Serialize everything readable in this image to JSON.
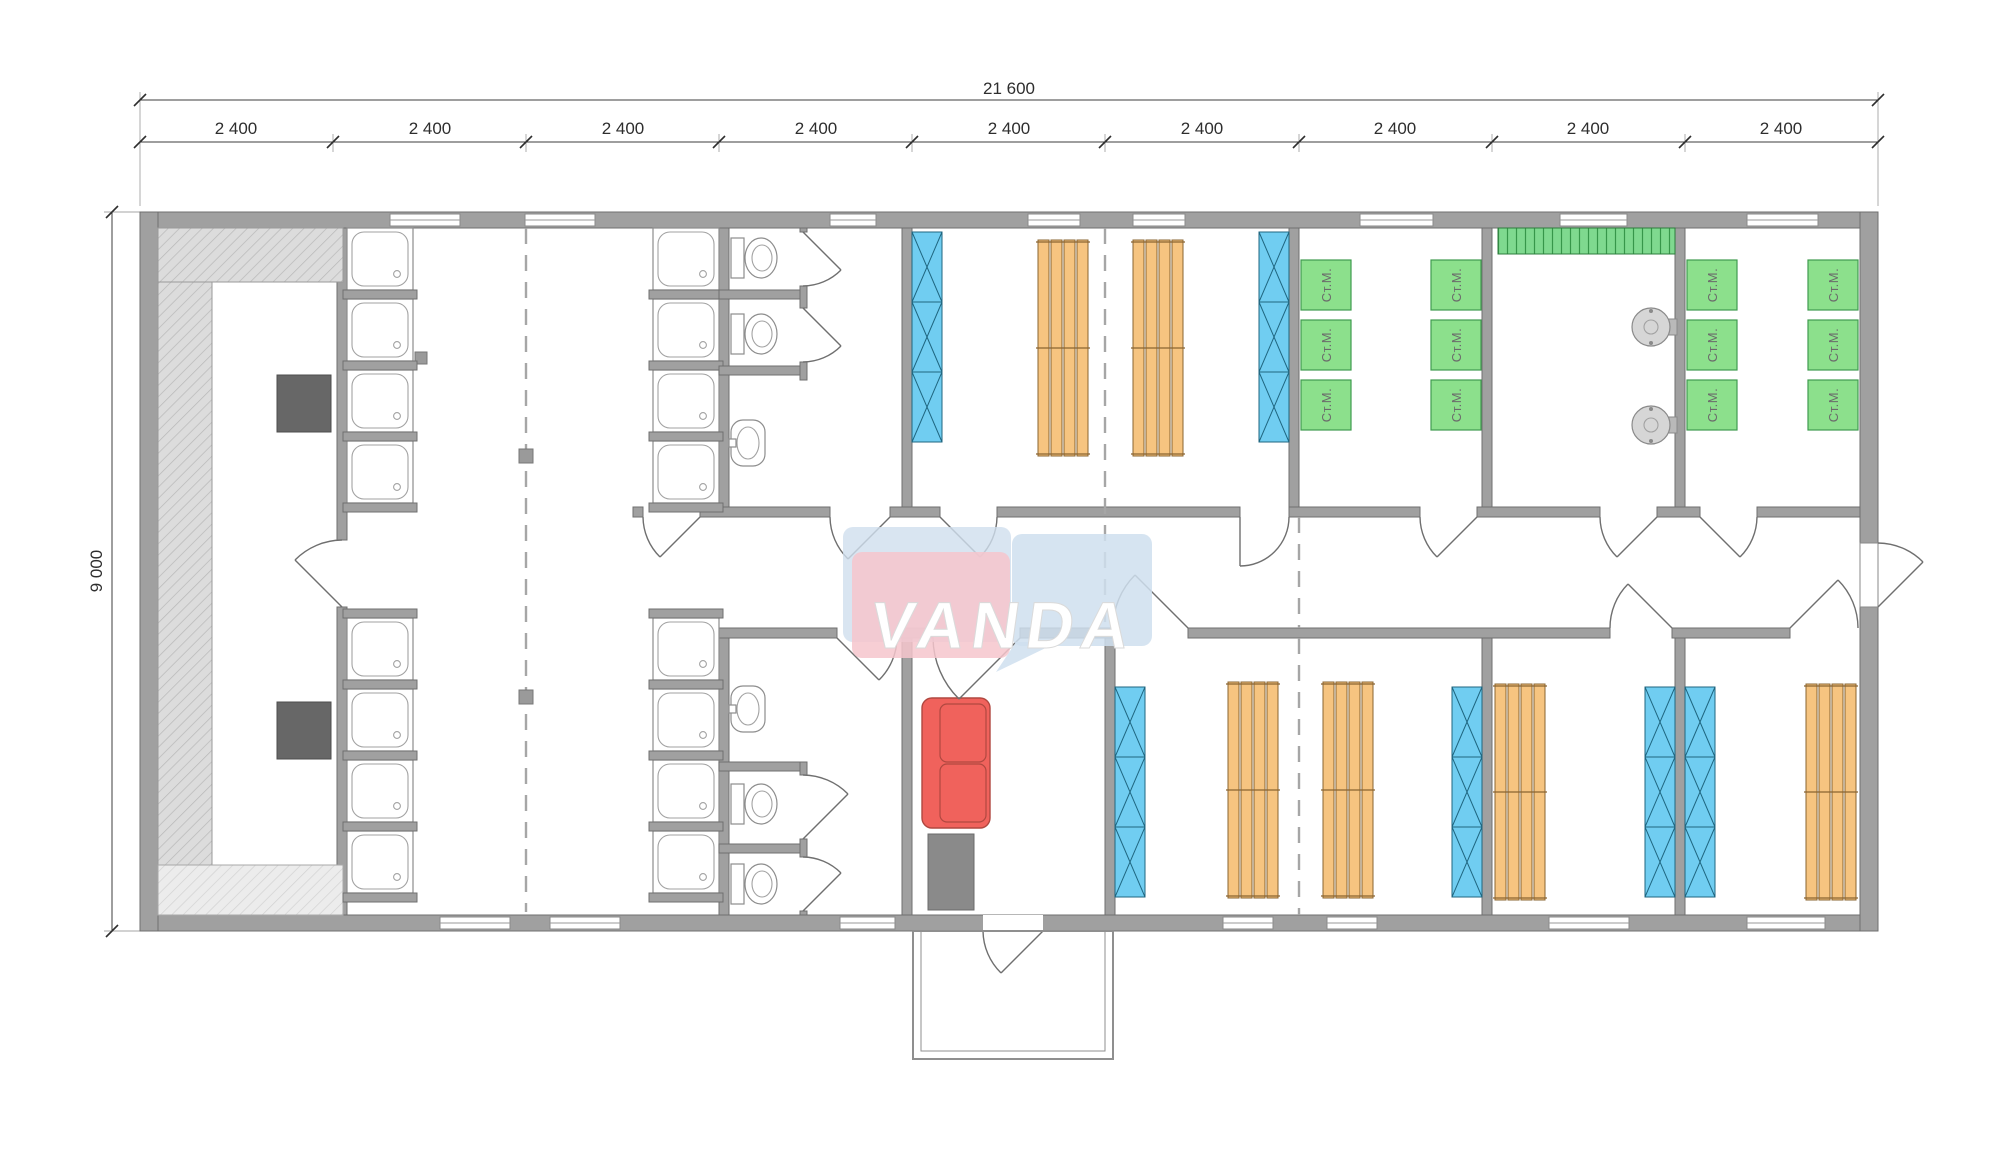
{
  "logo": {
    "text": "VANDA"
  },
  "dimensions": {
    "total_width": "21 600",
    "building_height": "9 000",
    "segments": [
      "2 400",
      "2 400",
      "2 400",
      "2 400",
      "2 400",
      "2 400",
      "2 400",
      "2 400",
      "2 400"
    ]
  },
  "appliances": {
    "washing_machine_label": "Ст.М."
  },
  "colors": {
    "wall": "#a0a0a0",
    "wall_edge": "#6f6f6f",
    "locker_blue": "#70cdf1",
    "bed_orange": "#f6c480",
    "machine_green": "#8ce08c",
    "machine_green_edge": "#3f9b4f",
    "counter_green": "#7fd98f",
    "sofa_red": "#f0625c",
    "stove_gray": "#676767",
    "bench_gray": "#dcdcdc",
    "logo_pink": "#f6c6cc",
    "logo_blue": "#cfdfee",
    "dim_text": "#2e2e2e"
  }
}
